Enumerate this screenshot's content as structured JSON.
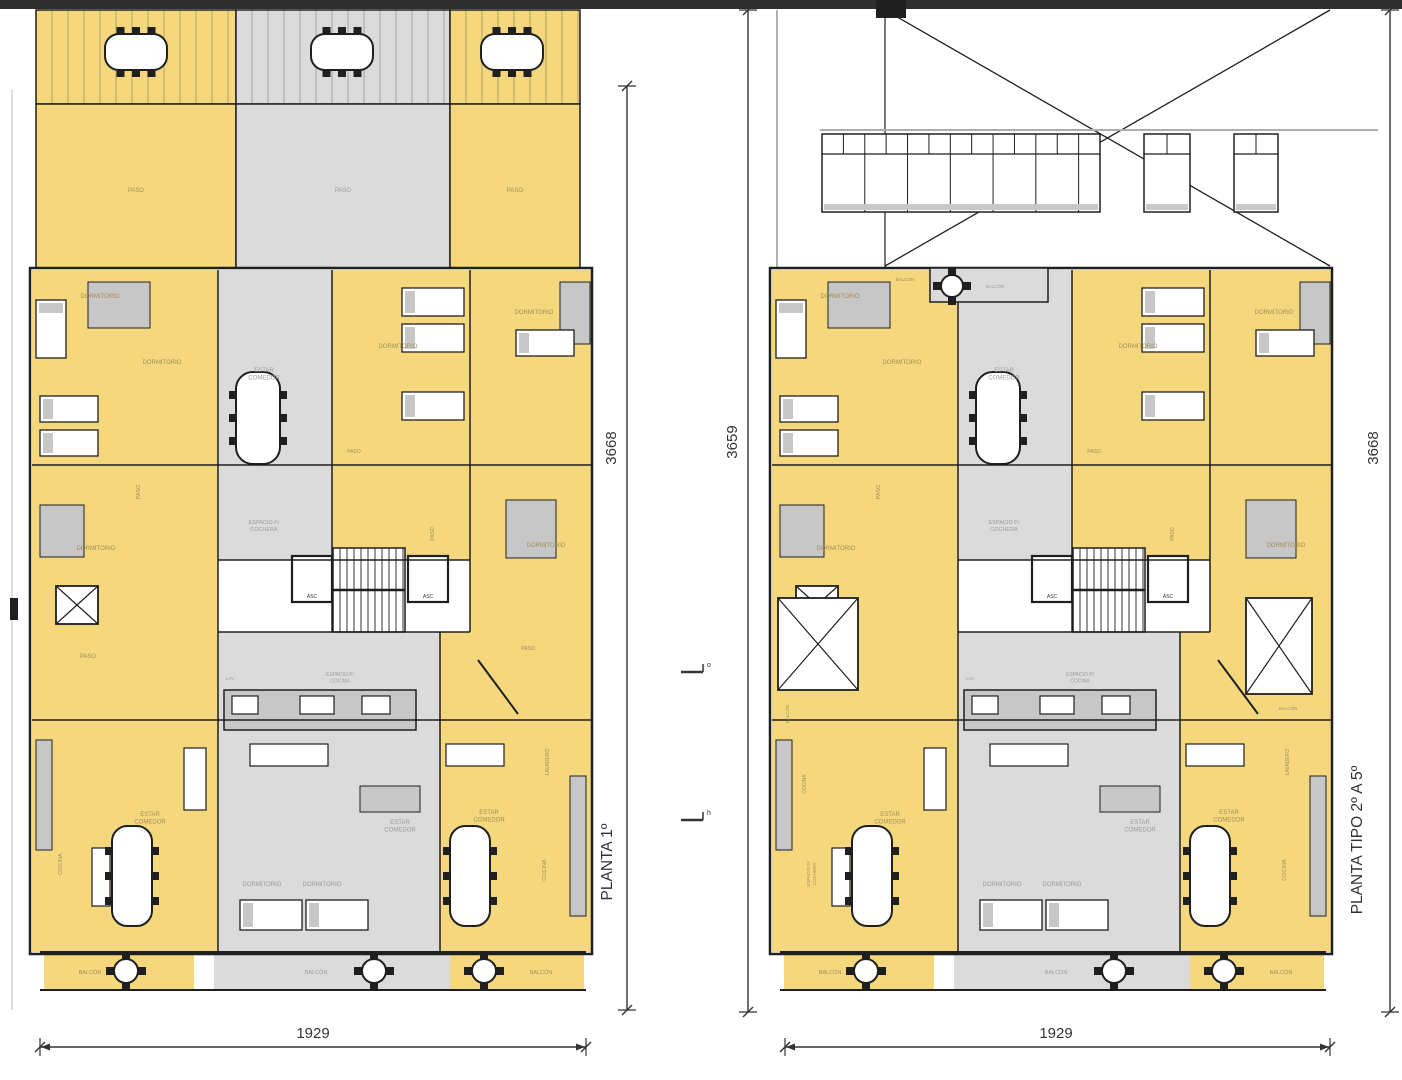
{
  "colors": {
    "yellow": "#F5D87E",
    "gray": "#DBDBDB",
    "white": "#FFFFFF",
    "furn": "#C7C7C7",
    "wall": "#1F1F1F",
    "stripe": "rgba(0,0,0,0.13)",
    "topbar": "#2E2E2E",
    "label_y": "#A08E56",
    "label_g": "#9B9B9B",
    "label_k": "#333333",
    "dim": "#333333"
  },
  "global": [
    {
      "t": "rect",
      "x": 0,
      "y": 0,
      "w": 1402,
      "h": 9,
      "f": "topbar"
    },
    {
      "t": "rect",
      "x": 876,
      "y": 0,
      "w": 30,
      "h": 18,
      "f": "wall"
    },
    {
      "t": "marker",
      "x": 693,
      "y": 672,
      "ch": "o"
    },
    {
      "t": "marker",
      "x": 693,
      "y": 820,
      "ch": "h"
    }
  ],
  "body": [
    {
      "t": "rect",
      "x": 32,
      "y": 270,
      "w": 186,
      "h": 450,
      "f": "yellow"
    },
    {
      "t": "rect",
      "x": 218,
      "y": 270,
      "w": 114,
      "h": 290,
      "f": "gray"
    },
    {
      "t": "rect",
      "x": 332,
      "y": 270,
      "w": 138,
      "h": 195,
      "f": "yellow"
    },
    {
      "t": "rect",
      "x": 470,
      "y": 270,
      "w": 122,
      "h": 362,
      "f": "yellow"
    },
    {
      "t": "rect",
      "x": 332,
      "y": 465,
      "w": 138,
      "h": 95,
      "f": "yellow"
    },
    {
      "t": "rect",
      "x": 218,
      "y": 560,
      "w": 252,
      "h": 72,
      "f": "white"
    },
    {
      "t": "rect",
      "x": 218,
      "y": 632,
      "w": 222,
      "h": 88,
      "f": "gray"
    },
    {
      "t": "rect",
      "x": 440,
      "y": 632,
      "w": 152,
      "h": 88,
      "f": "yellow"
    },
    {
      "t": "rect",
      "x": 32,
      "y": 720,
      "w": 186,
      "h": 232,
      "f": "yellow"
    },
    {
      "t": "rect",
      "x": 218,
      "y": 720,
      "w": 222,
      "h": 232,
      "f": "gray"
    },
    {
      "t": "rect",
      "x": 440,
      "y": 720,
      "w": 152,
      "h": 232,
      "f": "yellow"
    },
    {
      "t": "rect",
      "x": 44,
      "y": 952,
      "w": 150,
      "h": 38,
      "f": "yellow"
    },
    {
      "t": "rect",
      "x": 214,
      "y": 952,
      "w": 236,
      "h": 38,
      "f": "gray"
    },
    {
      "t": "rect",
      "x": 450,
      "y": 952,
      "w": 134,
      "h": 38,
      "f": "yellow"
    },
    {
      "t": "rect",
      "x": 88,
      "y": 282,
      "w": 62,
      "h": 46,
      "f": "furn",
      "s": 1
    },
    {
      "t": "rect",
      "x": 560,
      "y": 282,
      "w": 30,
      "h": 62,
      "f": "furn",
      "s": 1
    },
    {
      "t": "rect",
      "x": 506,
      "y": 500,
      "w": 50,
      "h": 58,
      "f": "furn",
      "s": 1
    },
    {
      "t": "rect",
      "x": 40,
      "y": 505,
      "w": 44,
      "h": 52,
      "f": "furn",
      "s": 1
    },
    {
      "t": "rect",
      "x": 360,
      "y": 786,
      "w": 60,
      "h": 26,
      "f": "furn",
      "s": 1
    },
    {
      "t": "rect",
      "x": 36,
      "y": 740,
      "w": 16,
      "h": 110,
      "f": "furn",
      "s": 1
    },
    {
      "t": "rect",
      "x": 570,
      "y": 776,
      "w": 16,
      "h": 140,
      "f": "furn",
      "s": 1
    },
    {
      "t": "rect",
      "x": 224,
      "y": 690,
      "w": 192,
      "h": 40,
      "f": "furn",
      "s": 1.5
    },
    {
      "t": "wrect",
      "x": 232,
      "y": 696,
      "w": 26,
      "h": 18
    },
    {
      "t": "wrect",
      "x": 300,
      "y": 696,
      "w": 34,
      "h": 18
    },
    {
      "t": "wrect",
      "x": 362,
      "y": 696,
      "w": 28,
      "h": 18
    },
    {
      "t": "bed",
      "x": 36,
      "y": 300,
      "w": 30,
      "h": 58
    },
    {
      "t": "bed",
      "x": 40,
      "y": 396,
      "w": 58,
      "h": 26
    },
    {
      "t": "bed",
      "x": 40,
      "y": 430,
      "w": 58,
      "h": 26
    },
    {
      "t": "bed",
      "x": 402,
      "y": 288,
      "w": 62,
      "h": 28
    },
    {
      "t": "bed",
      "x": 402,
      "y": 324,
      "w": 62,
      "h": 28
    },
    {
      "t": "bed",
      "x": 402,
      "y": 392,
      "w": 62,
      "h": 28
    },
    {
      "t": "bed",
      "x": 516,
      "y": 330,
      "w": 58,
      "h": 26
    },
    {
      "t": "bed",
      "x": 240,
      "y": 900,
      "w": 62,
      "h": 30
    },
    {
      "t": "bed",
      "x": 306,
      "y": 900,
      "w": 62,
      "h": 30
    },
    {
      "t": "wrect",
      "x": 250,
      "y": 744,
      "w": 78,
      "h": 22
    },
    {
      "t": "wrect",
      "x": 446,
      "y": 744,
      "w": 58,
      "h": 22
    },
    {
      "t": "wrect",
      "x": 184,
      "y": 748,
      "w": 22,
      "h": 62
    },
    {
      "t": "wrect",
      "x": 92,
      "y": 848,
      "w": 18,
      "h": 58
    },
    {
      "t": "oval",
      "cx": 258,
      "cy": 418,
      "w": 44,
      "h": 92
    },
    {
      "t": "oval",
      "cx": 132,
      "cy": 876,
      "w": 40,
      "h": 100
    },
    {
      "t": "oval",
      "cx": 470,
      "cy": 876,
      "w": 40,
      "h": 100
    },
    {
      "t": "round",
      "cx": 126,
      "cy": 971,
      "r": 12
    },
    {
      "t": "round",
      "cx": 374,
      "cy": 971,
      "r": 12
    },
    {
      "t": "round",
      "cx": 484,
      "cy": 971,
      "r": 12
    },
    {
      "t": "stairs",
      "x": 333,
      "y": 548,
      "w": 72,
      "h": 84
    },
    {
      "t": "elev",
      "x": 292,
      "y": 556,
      "w": 40,
      "h": 46
    },
    {
      "t": "elev",
      "x": 408,
      "y": 556,
      "w": 40,
      "h": 46
    },
    {
      "t": "xbox",
      "x": 56,
      "y": 586,
      "w": 42,
      "h": 38
    },
    {
      "t": "line",
      "x1": 478,
      "y1": 660,
      "x2": 518,
      "y2": 714,
      "w": 2
    },
    {
      "t": "rect",
      "x": 30,
      "y": 268,
      "w": 562,
      "h": 686,
      "f": "none",
      "s": 2.5
    },
    {
      "t": "line",
      "x1": 218,
      "y1": 270,
      "x2": 218,
      "y2": 952,
      "w": 1.5
    },
    {
      "t": "line",
      "x1": 332,
      "y1": 270,
      "x2": 332,
      "y2": 632,
      "w": 1.5
    },
    {
      "t": "line",
      "x1": 440,
      "y1": 632,
      "x2": 440,
      "y2": 952,
      "w": 1.5
    },
    {
      "t": "line",
      "x1": 470,
      "y1": 270,
      "x2": 470,
      "y2": 632,
      "w": 1.5
    },
    {
      "t": "line",
      "x1": 32,
      "y1": 465,
      "x2": 592,
      "y2": 465,
      "w": 1.5
    },
    {
      "t": "line",
      "x1": 218,
      "y1": 560,
      "x2": 470,
      "y2": 560,
      "w": 1.5
    },
    {
      "t": "line",
      "x1": 218,
      "y1": 632,
      "x2": 470,
      "y2": 632,
      "w": 1.5
    },
    {
      "t": "line",
      "x1": 32,
      "y1": 720,
      "x2": 592,
      "y2": 720,
      "w": 1.5
    },
    {
      "t": "line",
      "x1": 40,
      "y1": 952,
      "x2": 586,
      "y2": 952,
      "w": 2
    },
    {
      "t": "line",
      "x1": 40,
      "y1": 990,
      "x2": 586,
      "y2": 990,
      "w": 2
    },
    {
      "t": "label",
      "text": "DORMITORIO",
      "x": 100,
      "y": 298,
      "s": 6,
      "c": "y"
    },
    {
      "t": "label",
      "text": "DORMITORIO",
      "x": 162,
      "y": 364,
      "s": 6,
      "c": "y"
    },
    {
      "t": "label",
      "text": "DORMITORIO",
      "x": 398,
      "y": 348,
      "s": 6,
      "c": "y"
    },
    {
      "t": "label",
      "text": "DORMITORIO",
      "x": 534,
      "y": 314,
      "s": 6,
      "c": "y"
    },
    {
      "t": "label",
      "text": "DORMITORIO",
      "x": 96,
      "y": 550,
      "s": 6,
      "c": "y"
    },
    {
      "t": "label",
      "text": "DORMITORIO",
      "x": 546,
      "y": 547,
      "s": 6,
      "c": "y"
    },
    {
      "t": "label",
      "text": "ESTAR\nCOMEDOR",
      "x": 264,
      "y": 372,
      "s": 6,
      "c": "g"
    },
    {
      "t": "label",
      "text": "ESPACIO P/\nCOCHERA",
      "x": 264,
      "y": 524,
      "s": 5.5,
      "c": "g"
    },
    {
      "t": "label",
      "text": "PASO",
      "x": 354,
      "y": 453,
      "s": 5,
      "c": "y"
    },
    {
      "t": "label",
      "text": "PASO",
      "x": 140,
      "y": 492,
      "s": 5.5,
      "c": "y",
      "r": -90
    },
    {
      "t": "label",
      "text": "PASO",
      "x": 434,
      "y": 534,
      "s": 5,
      "c": "y",
      "r": -90
    },
    {
      "t": "label",
      "text": "ASC",
      "x": 312,
      "y": 598,
      "s": 5,
      "c": "k"
    },
    {
      "t": "label",
      "text": "ASC",
      "x": 428,
      "y": 598,
      "s": 5,
      "c": "k"
    },
    {
      "t": "label",
      "text": "LAV",
      "x": 230,
      "y": 680,
      "s": 4.5,
      "c": "g"
    },
    {
      "t": "label",
      "text": "ESPACIO P/\nCOCINA",
      "x": 340,
      "y": 676,
      "s": 5,
      "c": "g"
    },
    {
      "t": "label",
      "text": "PASO",
      "x": 88,
      "y": 658,
      "s": 6,
      "c": "y"
    },
    {
      "t": "label",
      "text": "PASO",
      "x": 528,
      "y": 650,
      "s": 5,
      "c": "y"
    },
    {
      "t": "label",
      "text": "LAVADERO",
      "x": 549,
      "y": 762,
      "s": 5,
      "c": "y",
      "r": -90
    },
    {
      "t": "label",
      "text": "ESTAR\nCOMEDOR",
      "x": 150,
      "y": 816,
      "s": 6,
      "c": "y"
    },
    {
      "t": "label",
      "text": "ESTAR\nCOMEDOR",
      "x": 400,
      "y": 824,
      "s": 6,
      "c": "g"
    },
    {
      "t": "label",
      "text": "ESTAR\nCOMEDOR",
      "x": 489,
      "y": 814,
      "s": 6,
      "c": "y"
    },
    {
      "t": "label",
      "text": "DORMITORIO",
      "x": 262,
      "y": 886,
      "s": 6,
      "c": "g"
    },
    {
      "t": "label",
      "text": "DORMITORIO",
      "x": 322,
      "y": 886,
      "s": 6,
      "c": "g"
    },
    {
      "t": "label",
      "text": "COCINA",
      "x": 546,
      "y": 870,
      "s": 5.5,
      "c": "y",
      "r": -90
    },
    {
      "t": "label",
      "text": "BALCÓN",
      "x": 90,
      "y": 974,
      "s": 5.5,
      "c": "y"
    },
    {
      "t": "label",
      "text": "BALCÓN",
      "x": 316,
      "y": 974,
      "s": 5.5,
      "c": "g"
    },
    {
      "t": "label",
      "text": "BALCÓN",
      "x": 541,
      "y": 974,
      "s": 5.5,
      "c": "y"
    }
  ],
  "plans": [
    {
      "name": "planta-1",
      "dx": 0,
      "title": "PLANTA 1º",
      "dim_side": "3668",
      "dim_bottom": "1929",
      "bg": [
        {
          "t": "rect",
          "x": 36,
          "y": 10,
          "w": 200,
          "h": 94,
          "f": "yellow",
          "s": 1.5
        },
        {
          "t": "rect",
          "x": 236,
          "y": 10,
          "w": 214,
          "h": 94,
          "f": "gray",
          "s": 1.5
        },
        {
          "t": "rect",
          "x": 450,
          "y": 10,
          "w": 130,
          "h": 94,
          "f": "yellow",
          "s": 1.5
        },
        {
          "t": "stripes",
          "x": 36,
          "y": 10,
          "w": 200,
          "h": 94,
          "step": 16
        },
        {
          "t": "stripes",
          "x": 236,
          "y": 10,
          "w": 214,
          "h": 94,
          "step": 16
        },
        {
          "t": "stripes",
          "x": 450,
          "y": 10,
          "w": 130,
          "h": 94,
          "step": 16
        },
        {
          "t": "rect",
          "x": 36,
          "y": 104,
          "w": 200,
          "h": 164,
          "f": "yellow",
          "s": 1.5
        },
        {
          "t": "rect",
          "x": 236,
          "y": 104,
          "w": 214,
          "h": 164,
          "f": "gray",
          "s": 1.5
        },
        {
          "t": "rect",
          "x": 450,
          "y": 104,
          "w": 130,
          "h": 164,
          "f": "yellow",
          "s": 1.5
        },
        {
          "t": "oval",
          "cx": 136,
          "cy": 52,
          "w": 62,
          "h": 36
        },
        {
          "t": "oval",
          "cx": 342,
          "cy": 52,
          "w": 62,
          "h": 36
        },
        {
          "t": "oval",
          "cx": 512,
          "cy": 52,
          "w": 62,
          "h": 36
        },
        {
          "t": "label",
          "text": "PASO",
          "x": 136,
          "y": 192,
          "s": 6,
          "c": "y"
        },
        {
          "t": "label",
          "text": "PASO",
          "x": 343,
          "y": 192,
          "s": 6,
          "c": "g"
        },
        {
          "t": "label",
          "text": "PASO",
          "x": 515,
          "y": 192,
          "s": 6,
          "c": "y"
        },
        {
          "t": "line",
          "x1": 12,
          "y1": 90,
          "x2": 12,
          "y2": 1010,
          "w": 1,
          "c": "#BBBBBB"
        },
        {
          "t": "rect",
          "x": 10,
          "y": 598,
          "w": 8,
          "h": 22,
          "f": "wall"
        },
        {
          "t": "dimv",
          "x": 627,
          "y1": 86,
          "y2": 1010
        },
        {
          "t": "dimh",
          "x1": 40,
          "x2": 586,
          "y": 1047
        }
      ],
      "fg": [
        {
          "t": "label",
          "text": "COCINA",
          "x": 62,
          "y": 864,
          "s": 5.5,
          "c": "y",
          "r": -90
        }
      ]
    },
    {
      "name": "planta-tipo-2-a-5",
      "dx": 740,
      "title": "PLANTA TIPO 2º A 5º",
      "dim_side": "3668",
      "dim_left": "3659",
      "dim_bottom": "1929",
      "bg": [
        {
          "t": "line",
          "x1": 777,
          "y1": 10,
          "x2": 777,
          "y2": 268,
          "w": 1,
          "c": "#666666"
        },
        {
          "t": "line",
          "x1": 885,
          "y1": 10,
          "x2": 885,
          "y2": 268,
          "w": 1.2
        },
        {
          "t": "line",
          "x1": 885,
          "y1": 10,
          "x2": 1330,
          "y2": 266,
          "w": 1.3
        },
        {
          "t": "line",
          "x1": 1330,
          "y1": 10,
          "x2": 885,
          "y2": 266,
          "w": 1.3
        },
        {
          "t": "line",
          "x1": 820,
          "y1": 130,
          "x2": 1378,
          "y2": 130,
          "w": 2,
          "c": "#ADADAD"
        },
        {
          "t": "win",
          "x": 822,
          "y": 134,
          "w": 278,
          "h": 78,
          "n": 13
        },
        {
          "t": "win",
          "x": 1144,
          "y": 134,
          "w": 46,
          "h": 78,
          "n": 2
        },
        {
          "t": "win",
          "x": 1234,
          "y": 134,
          "w": 44,
          "h": 78,
          "n": 2
        },
        {
          "t": "dimv",
          "x": 748,
          "y1": 10,
          "y2": 1012
        },
        {
          "t": "dimv",
          "x": 1390,
          "y1": 10,
          "y2": 1012
        },
        {
          "t": "dimh",
          "x1": 785,
          "x2": 1330,
          "y": 1047
        }
      ],
      "fg": [
        {
          "t": "rect",
          "x": 930,
          "y": 268,
          "w": 118,
          "h": 34,
          "f": "gray",
          "s": 1.5
        },
        {
          "t": "round",
          "cx": 952,
          "cy": 286,
          "r": 11
        },
        {
          "t": "label",
          "text": "BALCÓN",
          "x": 905,
          "y": 281,
          "s": 4.5,
          "c": "y"
        },
        {
          "t": "label",
          "text": "BALCÓN",
          "x": 995,
          "y": 288,
          "s": 4.5,
          "c": "g"
        },
        {
          "t": "xbox",
          "x": 778,
          "y": 598,
          "w": 80,
          "h": 92
        },
        {
          "t": "xbox",
          "x": 1246,
          "y": 598,
          "w": 66,
          "h": 96
        },
        {
          "t": "label",
          "text": "BALCÓN",
          "x": 789,
          "y": 714,
          "s": 4.5,
          "c": "y",
          "r": -90
        },
        {
          "t": "label",
          "text": "BALCÓN",
          "x": 1288,
          "y": 710,
          "s": 4.5,
          "c": "y"
        },
        {
          "t": "label",
          "text": "COCINA",
          "x": 806,
          "y": 784,
          "s": 5,
          "c": "y",
          "r": -90
        },
        {
          "t": "label",
          "text": "ESPACIO P/\nCOCHERA",
          "x": 810,
          "y": 874,
          "s": 4.5,
          "c": "y",
          "r": -90
        }
      ]
    }
  ]
}
